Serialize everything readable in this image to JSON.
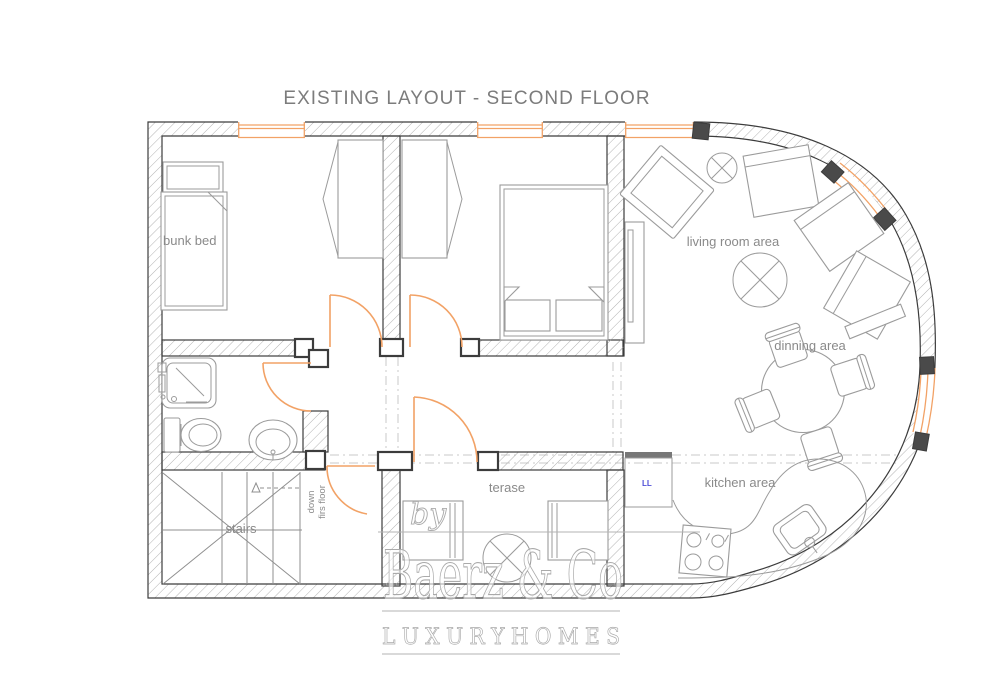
{
  "title": "EXISTING LAYOUT - SECOND FLOOR",
  "labels": {
    "bunk_bed": "bunk bed",
    "living_room": "living room area",
    "dining": "dinning area",
    "kitchen": "kitchen area",
    "terrace": "terase",
    "appliance": "LL"
  },
  "stairs": {
    "label": "stairs",
    "note1": "down",
    "note2": "firs floor"
  },
  "watermark": {
    "by": "by",
    "brand": "Baerz & Co",
    "tagline": "L U X U R Y   H O M E S"
  },
  "colors": {
    "wall_outline": "#3c3c3c",
    "hatch": "#ababab",
    "furniture": "#9b9b9b",
    "door_orange": "#f2a266",
    "label_gray": "#8a8a8a",
    "title_gray": "#7c7c7c",
    "appliance_blue": "#5050d8",
    "watermark_gray": "#aaaaaa",
    "dash_gray": "#c9c9c9"
  }
}
